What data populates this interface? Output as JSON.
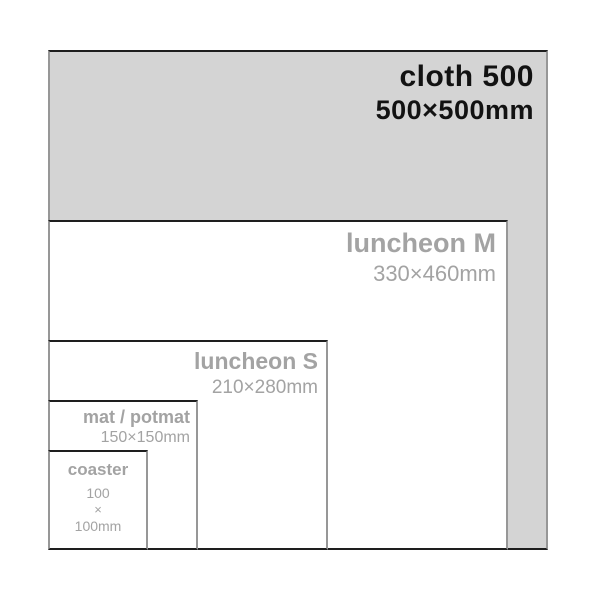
{
  "diagram": {
    "title": "product size comparison",
    "unit_scale": "1px = 1mm",
    "items": {
      "cloth": {
        "label": "cloth 500",
        "dimensions": "500×500mm",
        "size_mm": [
          500,
          500
        ]
      },
      "luncheon_m": {
        "label": "luncheon M",
        "dimensions": "330×460mm",
        "size_mm": [
          330,
          460
        ]
      },
      "luncheon_s": {
        "label": "luncheon S",
        "dimensions": "210×280mm",
        "size_mm": [
          210,
          280
        ]
      },
      "mat": {
        "label": "mat / potmat",
        "dimensions": "150×150mm",
        "size_mm": [
          150,
          150
        ]
      },
      "coaster": {
        "label": "coaster",
        "dimension_lines": [
          "100",
          "×",
          "100mm"
        ],
        "size_mm": [
          100,
          100
        ]
      }
    },
    "colors": {
      "background": "#ffffff",
      "cloth_fill": "#d4d4d4",
      "inner_fill": "#ffffff",
      "label_black": "#121212",
      "label_gray": "#a3a3a3",
      "border_horizontal": "#1e1e1e",
      "border_vertical": "#979797"
    }
  }
}
